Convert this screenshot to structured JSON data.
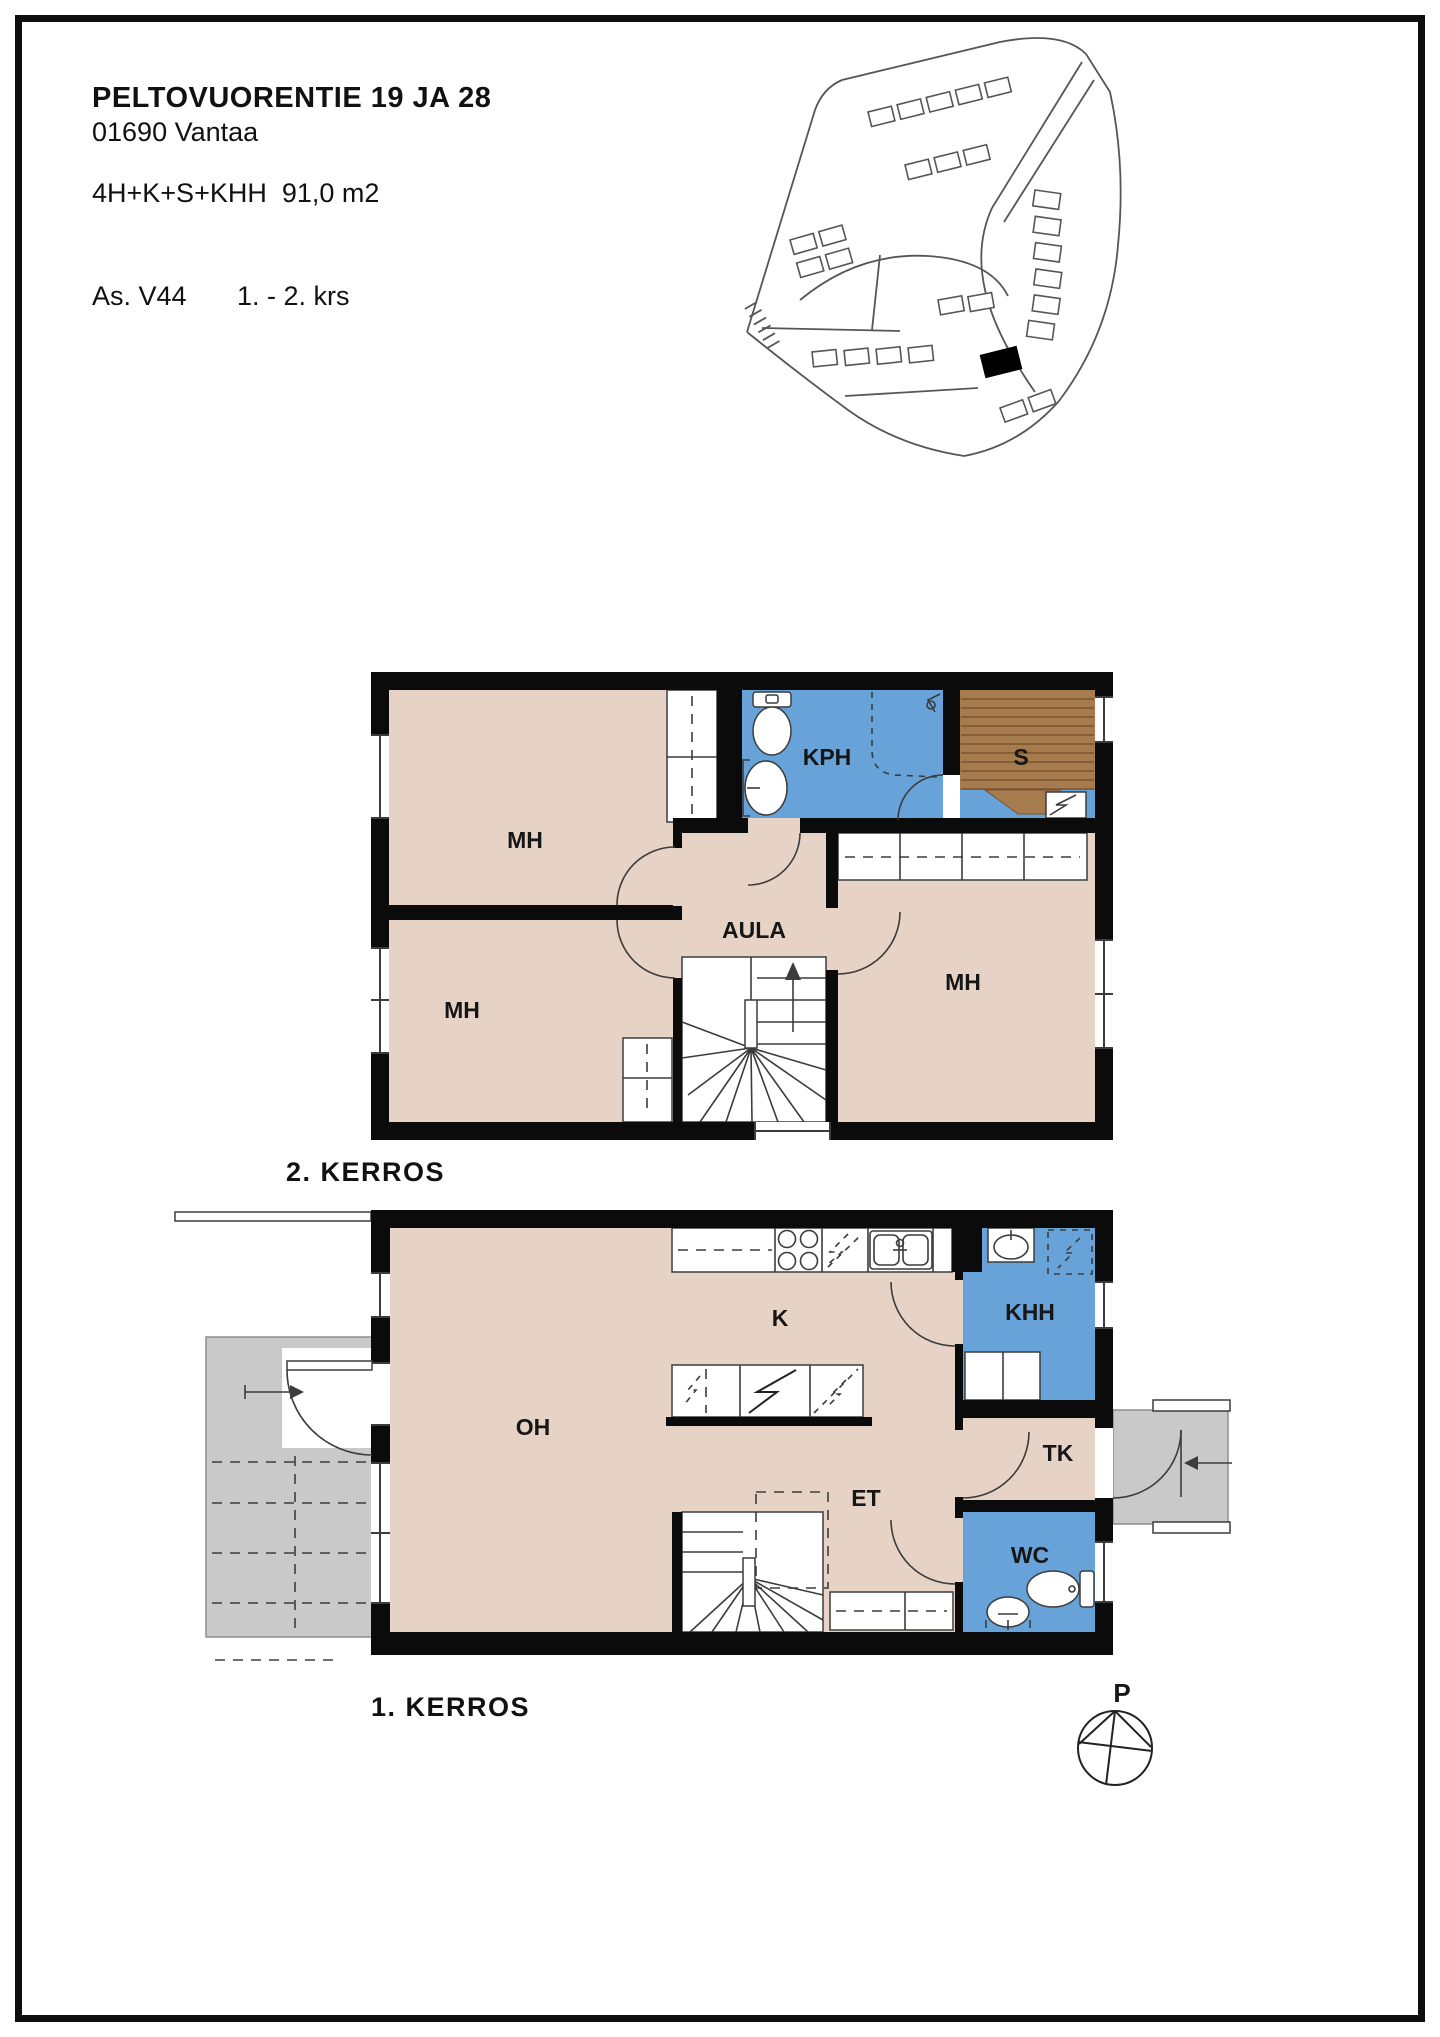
{
  "header": {
    "title": "PELTOVUORENTIE 19 JA 28",
    "address": "01690 Vantaa",
    "spec": "4H+K+S+KHH  91,0 m2",
    "apartment": "As. V44",
    "floors": "1. - 2. krs"
  },
  "floor2": {
    "caption": "2. KERROS",
    "rooms": {
      "mh_top_left": "MH",
      "kph": "KPH",
      "sauna": "S",
      "aula": "AULA",
      "mh_bottom_left": "MH",
      "mh_right": "MH"
    }
  },
  "floor1": {
    "caption": "1. KERROS",
    "rooms": {
      "oh": "OH",
      "k": "K",
      "khh": "KHH",
      "tk": "TK",
      "et": "ET",
      "wc": "WC"
    }
  },
  "compass": {
    "north_label": "P"
  },
  "colors": {
    "wall": "#0b0b0b",
    "room_beige": "#e6d3c5",
    "wet_room_blue": "#67a3d8",
    "sauna_brown": "#a67c4f",
    "terrace_gray": "#c9c9c9",
    "line": "#3c3c3c"
  }
}
